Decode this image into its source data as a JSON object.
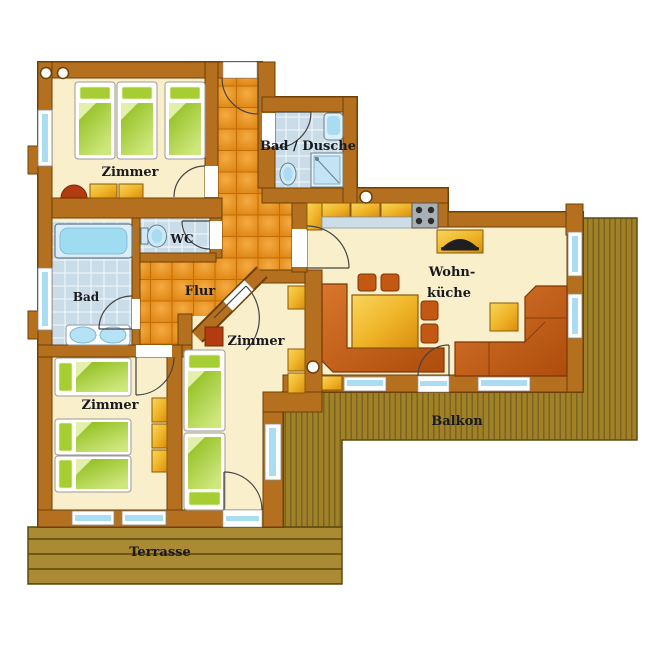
{
  "floorplan": {
    "labels": {
      "room_top": "Zimmer",
      "bath_shower": "Bad / Dusche",
      "wc": "WC",
      "bath": "Bad",
      "hall": "Flur",
      "living_kitchen_1": "Wohn-",
      "living_kitchen_2": "küche",
      "room_left": "Zimmer",
      "room_middle": "Zimmer",
      "balcony": "Balkon",
      "terrace": "Terrasse"
    },
    "colors": {
      "wall": "#b4701e",
      "wall_outline": "#6e3f06",
      "room_floor": "#f9efca",
      "hall_tiles": "#e08a14",
      "bath_tiles": "#c9dce8",
      "bed_linen": "#8fbe1e",
      "wood_furniture": "#e8a81e",
      "upholstery": "#c05a12",
      "deck_wood": "#a28530",
      "glass": "#aadcf2"
    },
    "rooms": [
      {
        "name": "bedroom-top",
        "label": "Zimmer",
        "items": [
          "3 beds",
          "cabinet",
          "washbasin"
        ]
      },
      {
        "name": "shower-bath",
        "label": "Bad / Dusche",
        "items": [
          "shower",
          "toilet",
          "sink"
        ]
      },
      {
        "name": "wc",
        "label": "WC",
        "items": [
          "toilet"
        ]
      },
      {
        "name": "bathroom",
        "label": "Bad",
        "items": [
          "bathtub",
          "double washbasin"
        ]
      },
      {
        "name": "hallway",
        "label": "Flur",
        "items": []
      },
      {
        "name": "living-kitchen",
        "label": "Wohn-küche",
        "items": [
          "kitchen counter",
          "stove",
          "tv",
          "dining table",
          "corner bench",
          "chairs",
          "corner sofa",
          "side table"
        ]
      },
      {
        "name": "bedroom-left",
        "label": "Zimmer",
        "items": [
          "3 beds",
          "wardrobe"
        ]
      },
      {
        "name": "bedroom-middle",
        "label": "Zimmer",
        "items": [
          "2 beds",
          "cabinets",
          "stool"
        ]
      },
      {
        "name": "balcony",
        "label": "Balkon",
        "items": []
      },
      {
        "name": "terrace",
        "label": "Terrasse",
        "items": []
      }
    ]
  }
}
